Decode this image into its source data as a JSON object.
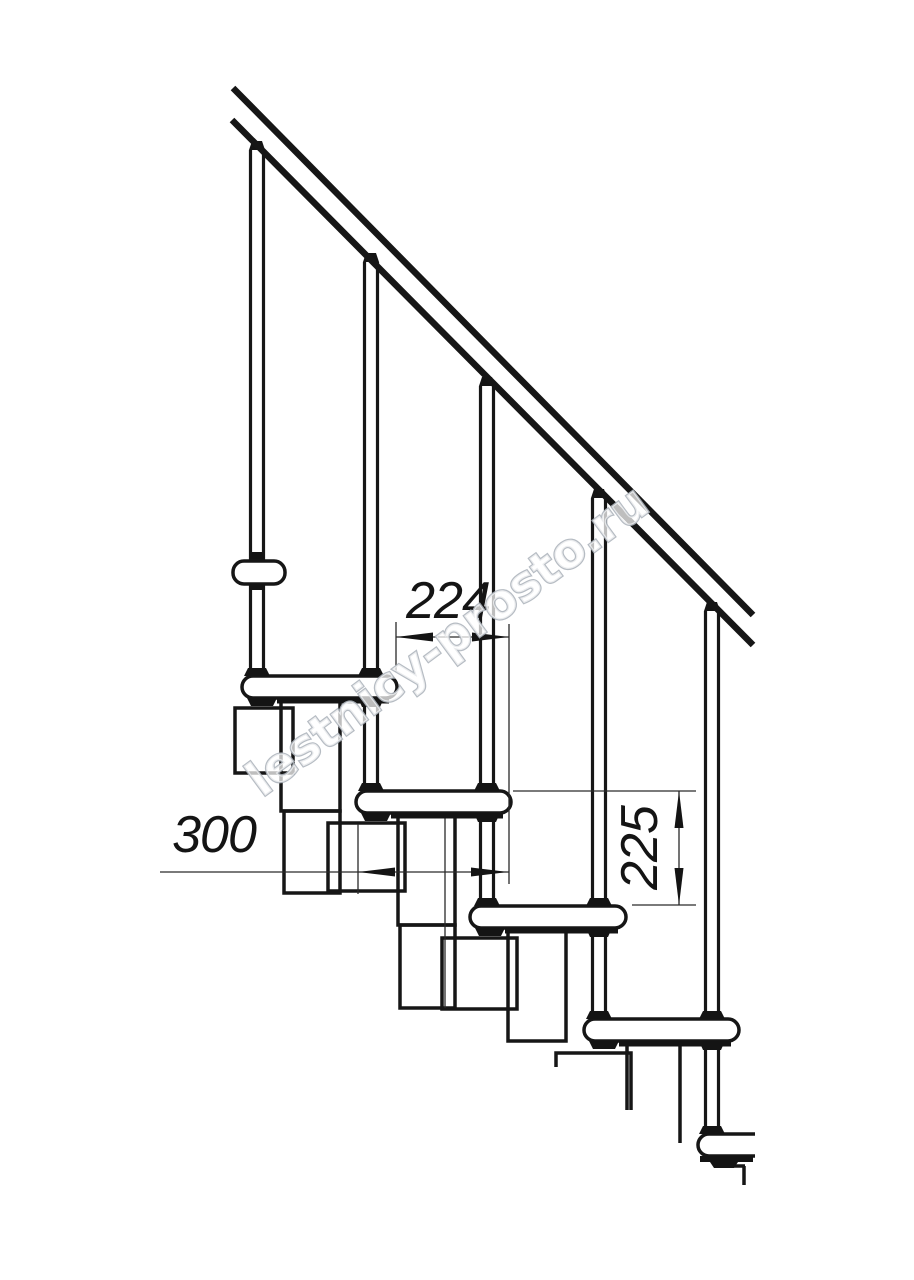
{
  "page": {
    "background": "#ffffff"
  },
  "drawing": {
    "description": "side elevation technical drawing of a modular staircase with handrail",
    "line_color": "#161616",
    "thin_line_color": "#2a2a2a",
    "dimensions": {
      "going": {
        "value": "224"
      },
      "tread_depth": {
        "value": "300"
      },
      "rise": {
        "value": "225"
      }
    },
    "watermark": {
      "text": "lestnicy-prosto.ru",
      "stroke_color": "#aeb5bd",
      "fill_color": "#ffffff"
    },
    "components": {
      "handrail_count": 1,
      "baluster_count": 5,
      "tread_count": 5,
      "support_post_count": 4
    }
  }
}
